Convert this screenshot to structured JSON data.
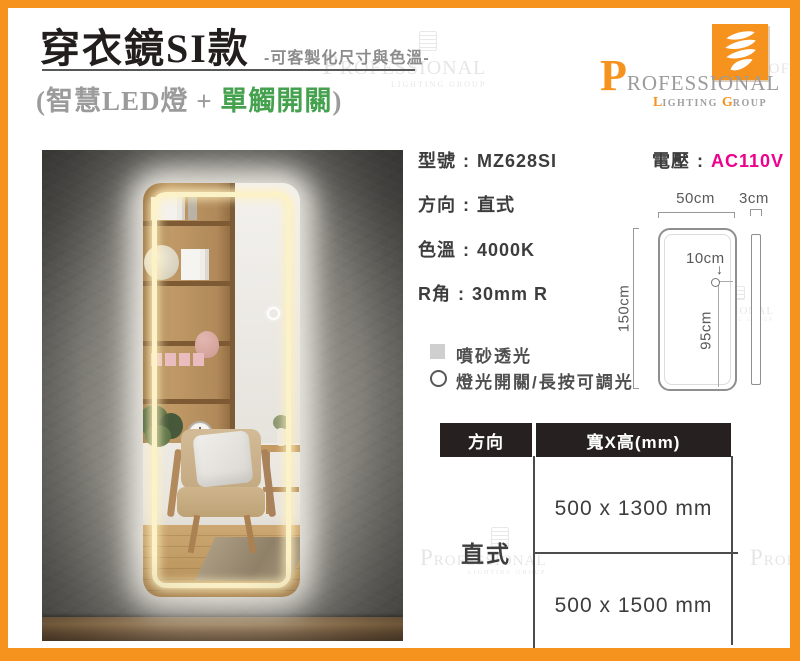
{
  "colors": {
    "accent_orange": "#F6921E",
    "voltage_pink": "#EC008C",
    "highlight_green": "#44A14E",
    "table_header_bg": "#262020"
  },
  "header": {
    "title": "穿衣鏡SI款",
    "subtitle": "-可客製化尺寸與色溫-",
    "tagline_prefix": "(智慧LED燈 + ",
    "tagline_highlight": "單觸開關",
    "tagline_suffix": ")"
  },
  "logo": {
    "initial": "P",
    "name_rest": "ROFESSIONAL",
    "sub_initial_1": "L",
    "sub_rest_1": "IGHTING",
    "sub_initial_2": "G",
    "sub_rest_2": "ROUP"
  },
  "ui": {
    "colon": ":",
    "down_arrow": "↓"
  },
  "specs": [
    {
      "label": "型號",
      "value": "MZ628SI"
    },
    {
      "label": "方向",
      "value": "直式"
    },
    {
      "label": "色溫",
      "value": "4000K"
    },
    {
      "label": "R角",
      "value": "30mm R"
    }
  ],
  "voltage": {
    "label": "電壓",
    "value": "AC110V"
  },
  "diagram": {
    "width": "50cm",
    "thickness": "3cm",
    "height": "150cm",
    "switch_edge_offset": "10cm",
    "switch_floor_height": "95cm"
  },
  "legend": [
    {
      "text": "噴砂透光"
    },
    {
      "text": "燈光開關/長按可調光"
    }
  ],
  "size_table": {
    "col1_header": "方向",
    "col2_header": "寬X高(mm)",
    "orientation": "直式",
    "sizes": [
      "500 x 1300 mm",
      "500 x 1500 mm"
    ]
  },
  "watermark": {
    "line1": "PROFESSIONAL",
    "line2": "LIGHTING GROUP"
  }
}
